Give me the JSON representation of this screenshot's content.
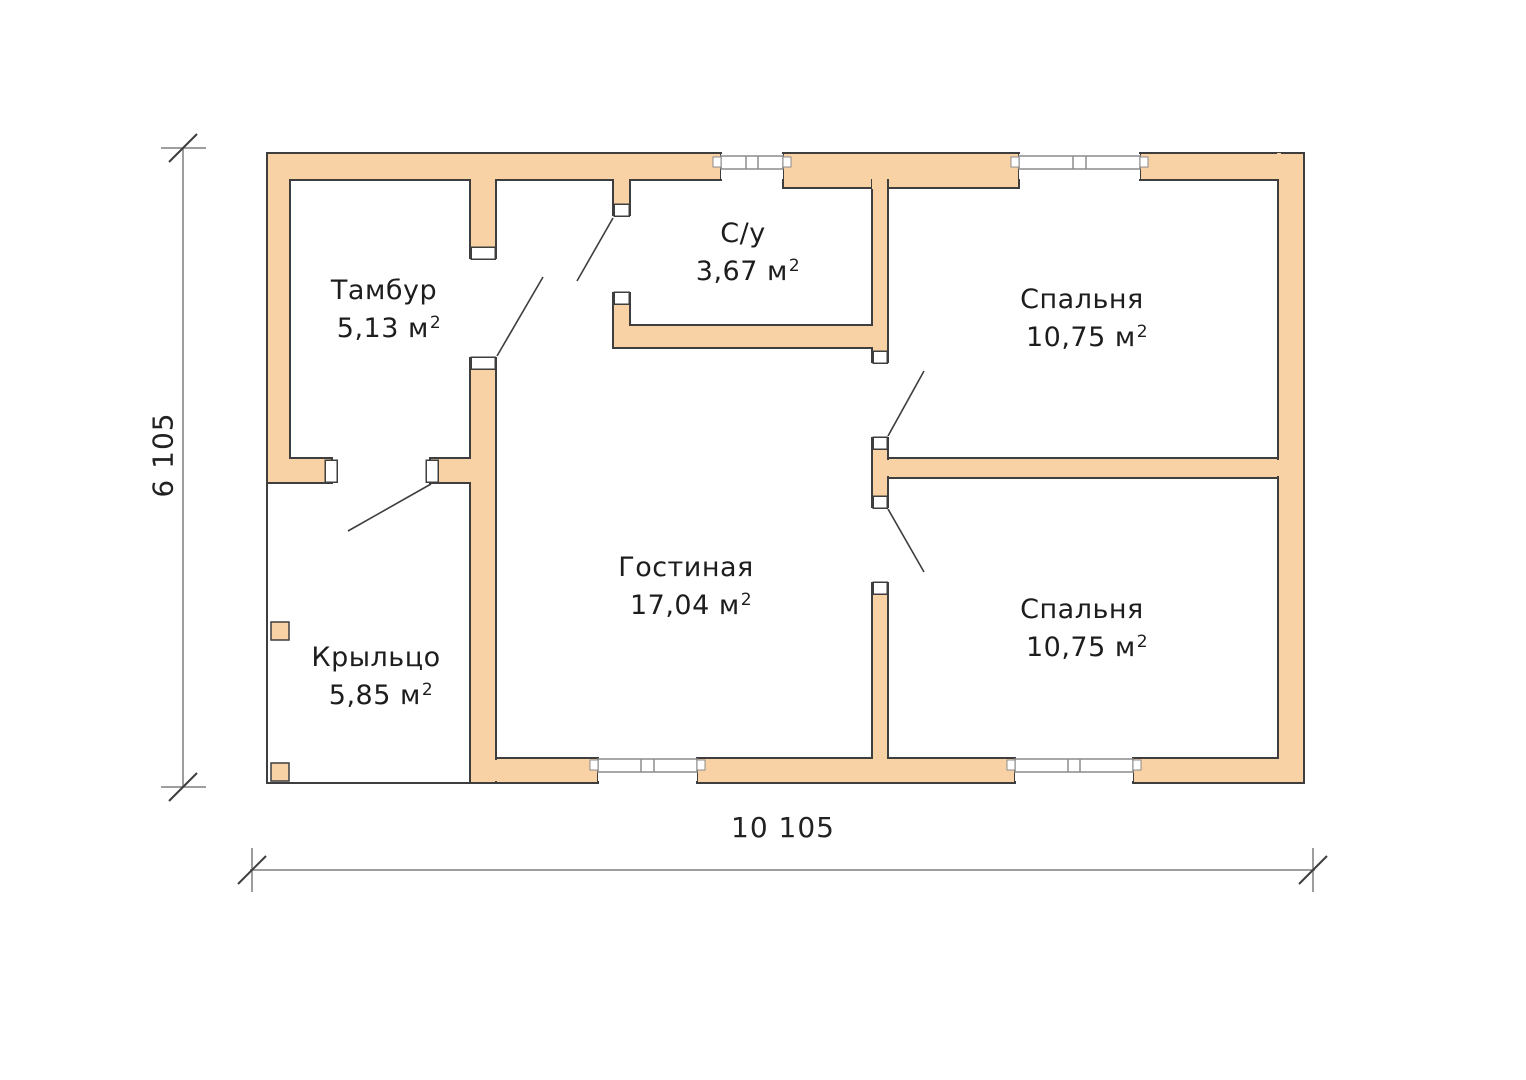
{
  "rooms": [
    {
      "id": "tambur",
      "name": "Тамбур",
      "area": "5,13 м",
      "area_sup": "2"
    },
    {
      "id": "su",
      "name": "С/у",
      "area": "3,67 м",
      "area_sup": "2"
    },
    {
      "id": "bedroom-top",
      "name": "Спальня",
      "area": "10,75 м",
      "area_sup": "2"
    },
    {
      "id": "gostinaya",
      "name": "Гостиная",
      "area": "17,04 м",
      "area_sup": "2"
    },
    {
      "id": "bedroom-bottom",
      "name": "Спальня",
      "area": "10,75 м",
      "area_sup": "2"
    },
    {
      "id": "porch",
      "name": "Крыльцо",
      "area": "5,85 м",
      "area_sup": "2"
    }
  ],
  "dimensions": {
    "height_label": "6 105",
    "width_label": "10 105"
  },
  "colors": {
    "wall_fill": "#f8d1a4",
    "wall_outline": "#3e3e3e",
    "window_line": "#8c8c8c",
    "dimension_line": "#7e7e7e",
    "text": "#1d1d1d",
    "background": "#ffffff"
  }
}
